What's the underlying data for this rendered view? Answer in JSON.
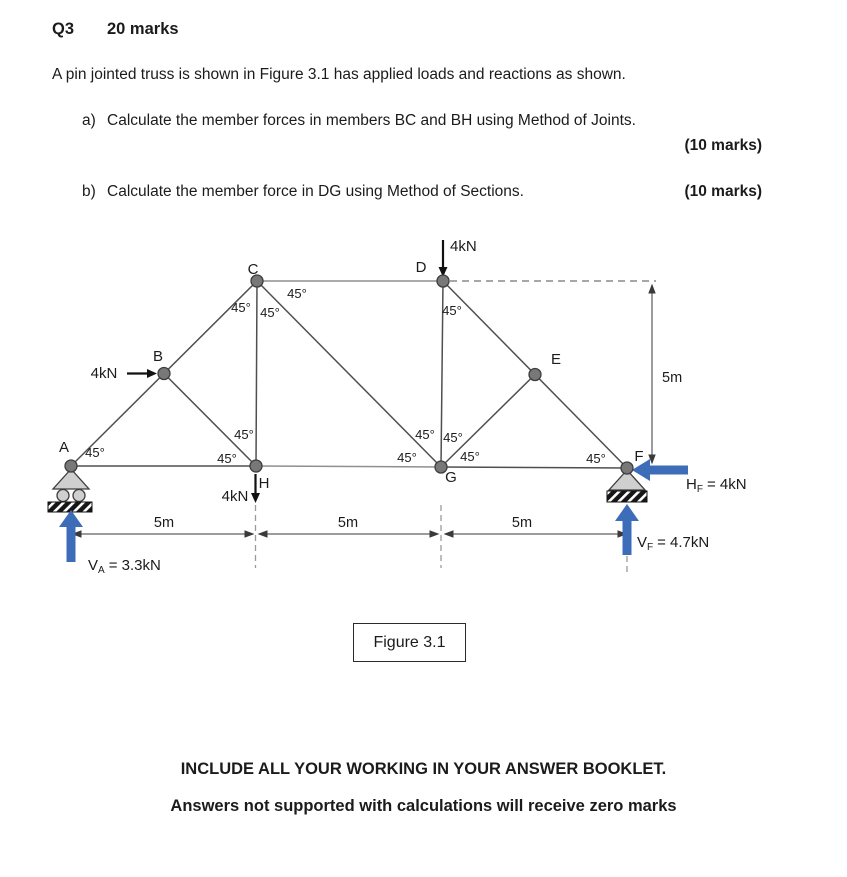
{
  "header": {
    "question": "Q3",
    "marks": "20 marks"
  },
  "intro": "A pin jointed truss is shown in Figure 3.1 has applied loads and reactions as shown.",
  "parts": {
    "a": {
      "label": "a)",
      "text": "Calculate the member forces in members BC and BH using Method of Joints.",
      "marks": "(10 marks)"
    },
    "b": {
      "label": "b)",
      "text": "Calculate the member force in DG using Method of Sections.",
      "marks": "(10 marks)"
    }
  },
  "figure": {
    "caption": "Figure 3.1"
  },
  "footer": {
    "line1": "INCLUDE ALL YOUR WORKING IN YOUR ANSWER BOOKLET.",
    "line2": "Answers not supported with calculations will receive zero marks"
  },
  "diagram": {
    "joints": {
      "a": "A",
      "b": "B",
      "c": "C",
      "d": "D",
      "e": "E",
      "f": "F",
      "g": "G",
      "h": "H"
    },
    "angle": "45°",
    "loads": {
      "at_b": "4kN",
      "at_d": "4kN",
      "at_h": "4kN"
    },
    "dims": {
      "h1": "5m",
      "h2": "5m",
      "h3": "5m",
      "v": "5m"
    },
    "reactions": {
      "va": {
        "sym": "V",
        "sub": "A",
        "val": "= 3.3kN"
      },
      "vf": {
        "sym": "V",
        "sub": "F",
        "val": "= 4.7kN"
      },
      "hf": {
        "sym": "H",
        "sub": "F",
        "val": "= 4kN"
      }
    },
    "colors": {
      "reaction_blue": "#3d6cb8"
    }
  }
}
